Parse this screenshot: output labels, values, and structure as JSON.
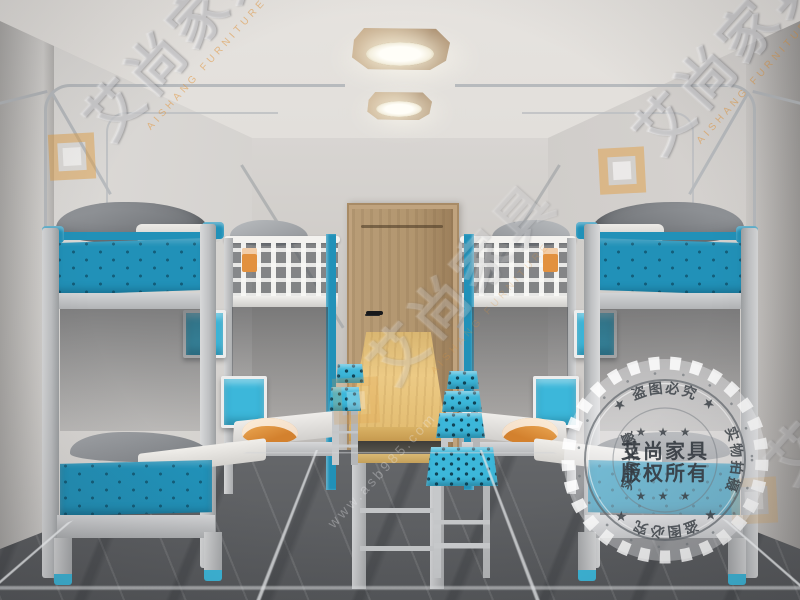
{
  "brand": {
    "name_cn": "艾尚家具",
    "name_en": "AISHANG FURNITURE"
  },
  "watermarks": {
    "diagonal_text": "艾尚家具",
    "diagonal_subtext": "AISHANG FURNITURE",
    "floor_url": "www.asb985.com"
  },
  "stamp": {
    "center_line1": "艾尚家具",
    "center_line2": "版权所有",
    "arc_top": "★ 盗图必究 ★",
    "arc_bottom": "★ 盗图必究 ★",
    "arc_left": "实物拍摄",
    "arc_right": "实物拍摄",
    "stars_top": "★ ★ ★",
    "stars_bottom": "★ ★ ★"
  },
  "colors": {
    "panel_blue": "#2191b8",
    "stool_blue": "#3cb7da",
    "accent_orange": "#e2913f",
    "table_wood": "#e3c07c",
    "door_wood": "#b2976f",
    "lamp_wood": "#b59a7a",
    "frame_gray": "#c6c8ca",
    "wall_gray": "#d2cfcc",
    "floor_gray": "#77797c"
  }
}
